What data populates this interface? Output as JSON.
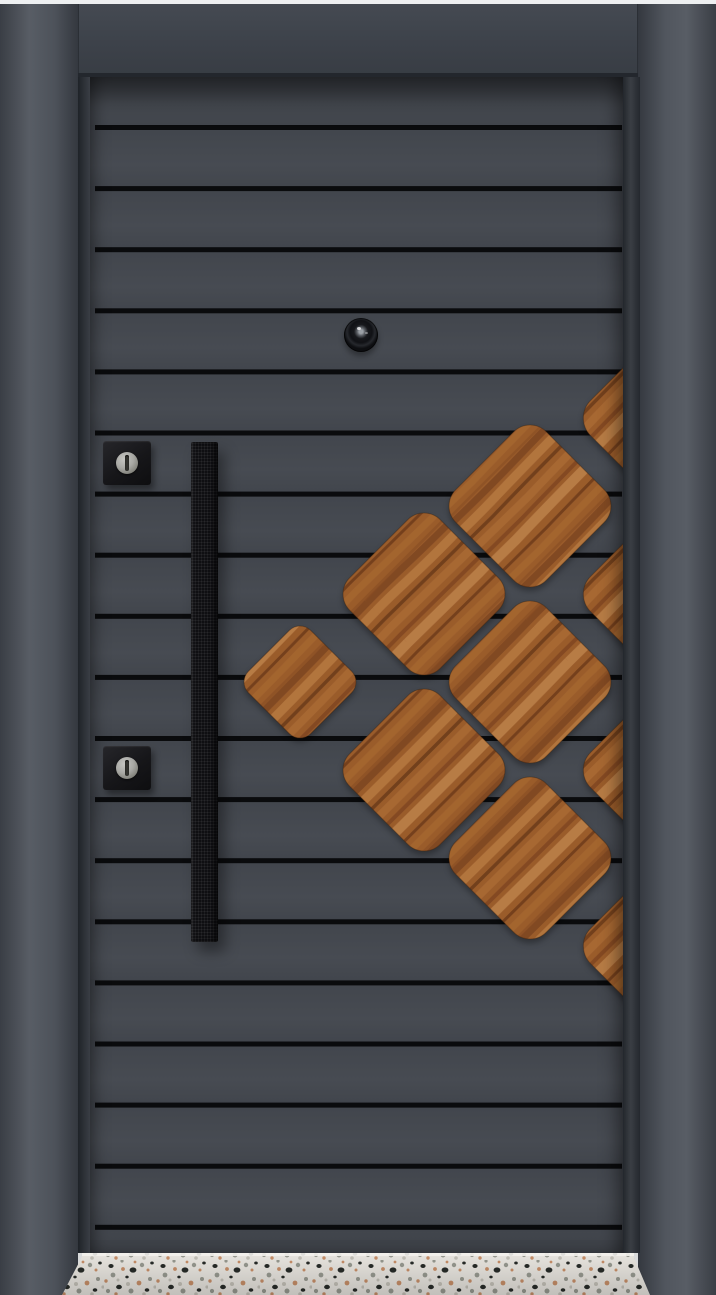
{
  "image_type": "product-photo",
  "subject": "steel-security-door-with-wood-diamond-inlay",
  "palette": {
    "strip": "#eef0f1",
    "frame_mid": "#4a4e56",
    "transom": "#3e434b",
    "leaf": "#43474e",
    "groove": "#0a0b0d",
    "wood_light": "#bc8049",
    "wood_mid": "#9a5c2c",
    "wood_dark": "#6b3a1a",
    "handle": "#0f0f12",
    "plate": "#1a1a1d",
    "metal": "#a8a8a4",
    "terrazzo_base": "#e7e4de",
    "terrazzo_speck_dark": "#272b28",
    "terrazzo_speck_gray": "#96988f",
    "terrazzo_speck_tan": "#c68e68"
  },
  "door": {
    "grooves": {
      "count": 19,
      "x": 95,
      "width": 527,
      "y_start": 125,
      "spacing": 61.1,
      "thickness": 5
    },
    "peephole": {
      "cx": 361,
      "cy": 335,
      "r": 17
    },
    "handle": {
      "x": 191,
      "y": 442,
      "w": 27,
      "h": 500
    },
    "escutcheons": [
      {
        "x": 103,
        "y": 441
      },
      {
        "x": 103,
        "y": 746
      }
    ],
    "wood_inlay": {
      "diamonds": [
        {
          "cx": 300,
          "cy": 682,
          "s": 44,
          "rx": 15,
          "edge": false
        },
        {
          "cx": 424,
          "cy": 594,
          "s": 64,
          "rx": 23,
          "edge": false
        },
        {
          "cx": 424,
          "cy": 770,
          "s": 64,
          "rx": 23,
          "edge": false
        },
        {
          "cx": 530,
          "cy": 506,
          "s": 64,
          "rx": 23,
          "edge": false
        },
        {
          "cx": 530,
          "cy": 682,
          "s": 64,
          "rx": 23,
          "edge": false
        },
        {
          "cx": 530,
          "cy": 858,
          "s": 64,
          "rx": 23,
          "edge": false
        },
        {
          "cx": 672,
          "cy": 418,
          "s": 70,
          "rx": 25,
          "edge": true
        },
        {
          "cx": 672,
          "cy": 594,
          "s": 70,
          "rx": 25,
          "edge": true
        },
        {
          "cx": 672,
          "cy": 770,
          "s": 70,
          "rx": 25,
          "edge": true
        },
        {
          "cx": 672,
          "cy": 946,
          "s": 70,
          "rx": 25,
          "edge": true
        }
      ]
    },
    "leaf_clip": {
      "x": 90,
      "y": 77,
      "w": 533,
      "h": 1176
    },
    "threshold": {
      "points": [
        [
          84,
          1253
        ],
        [
          632,
          1253
        ],
        [
          650,
          1295
        ],
        [
          62,
          1295
        ]
      ],
      "highlight": {
        "x": 82,
        "y": 1253,
        "w": 552,
        "h": 3
      }
    }
  }
}
